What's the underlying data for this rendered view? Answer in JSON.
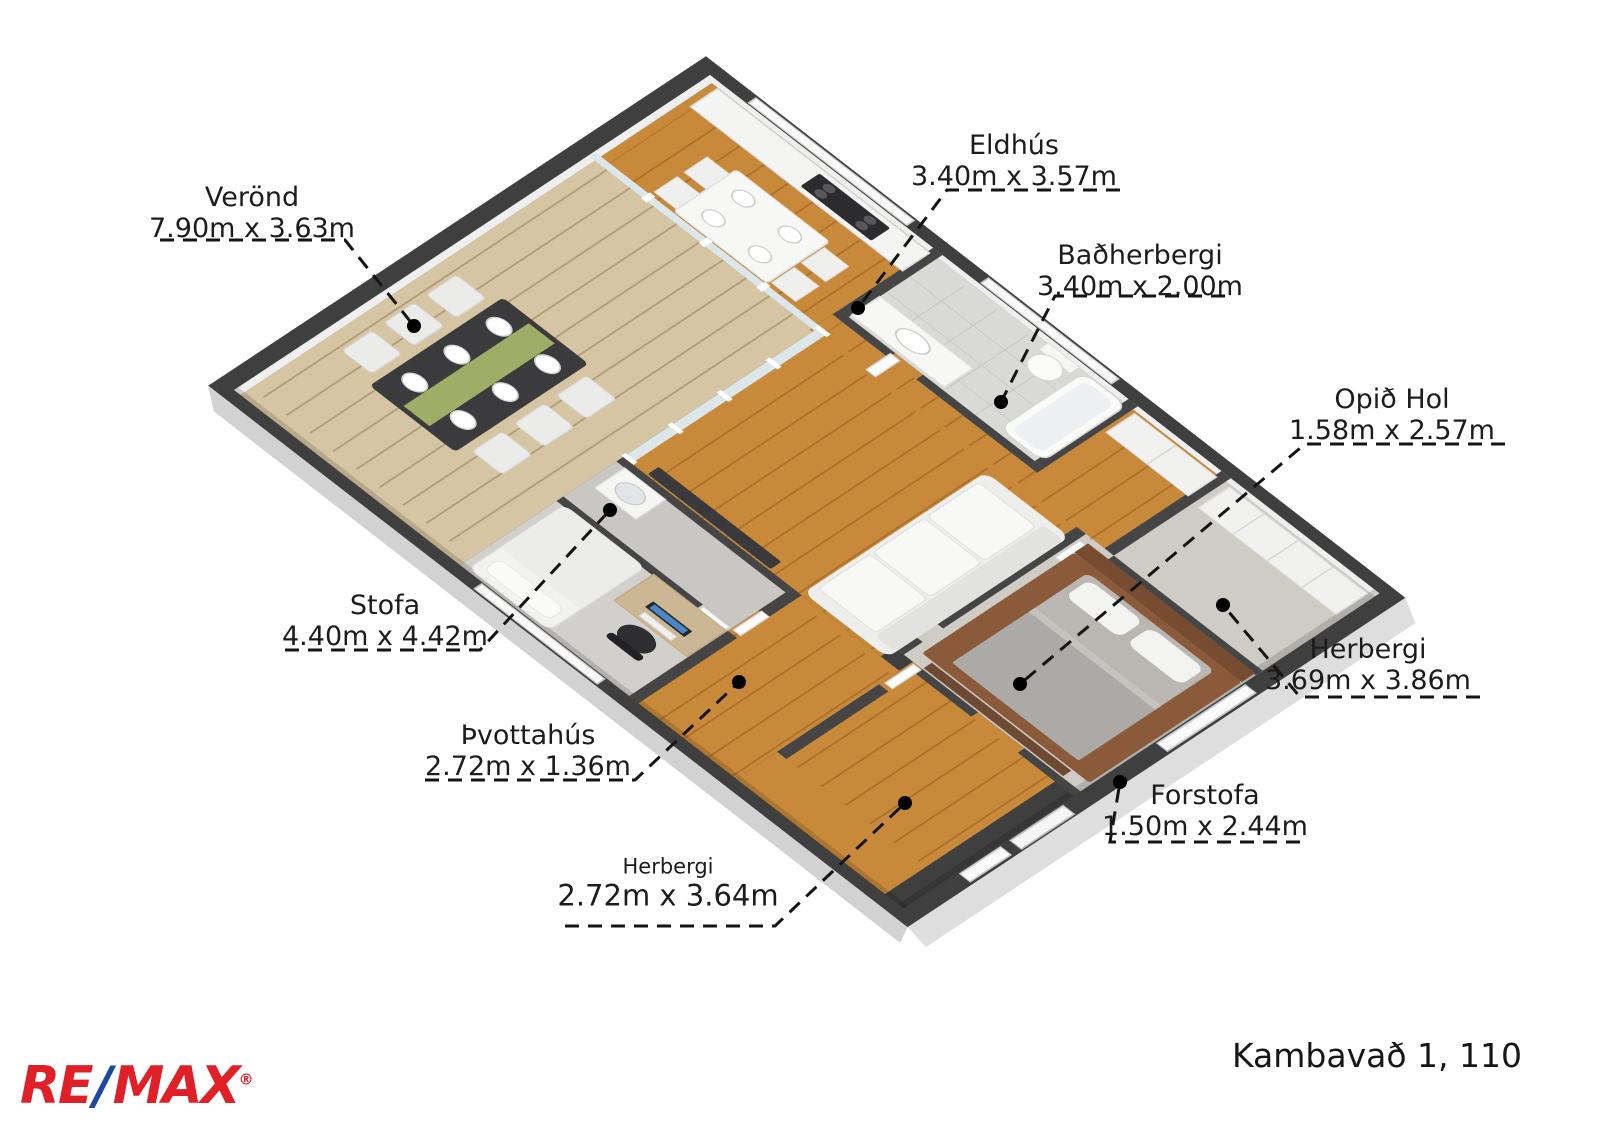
{
  "rooms": [
    {
      "id": "verond",
      "name": "Verönd",
      "dims": "7.90m x 3.63m"
    },
    {
      "id": "eldhus",
      "name": "Eldhús",
      "dims": "3.40m x 3.57m"
    },
    {
      "id": "badherbergi",
      "name": "Baðherbergi",
      "dims": "3.40m x 2.00m"
    },
    {
      "id": "opid-hol",
      "name": "Opið Hol",
      "dims": "1.58m x 2.57m"
    },
    {
      "id": "stofa",
      "name": "Stofa",
      "dims": "4.40m x 4.42m"
    },
    {
      "id": "herbergi-haegri",
      "name": "Herbergi",
      "dims": "3.69m x 3.86m"
    },
    {
      "id": "thvottahus",
      "name": "Þvottahús",
      "dims": "2.72m x 1.36m"
    },
    {
      "id": "forstofa",
      "name": "Forstofa",
      "dims": "1.50m x 2.44m"
    },
    {
      "id": "herbergi-nedri",
      "name": "Herbergi",
      "dims": "2.72m x 3.64m"
    }
  ],
  "footer": {
    "address": "Kambavað 1, 110"
  },
  "brand": {
    "re": "RE",
    "slash": "/",
    "max": "MAX",
    "registered": "®",
    "red": "#e01f26",
    "blue": "#1d49a5"
  },
  "palette": {
    "wall": "#3f3f3f",
    "wood": "#c9893a",
    "deck": "#d5c5a2",
    "tile": "#d9d9d5",
    "carpet": "#cfccc6",
    "bed_platform": "#8a5a3b",
    "runner_green": "#9fae66"
  }
}
